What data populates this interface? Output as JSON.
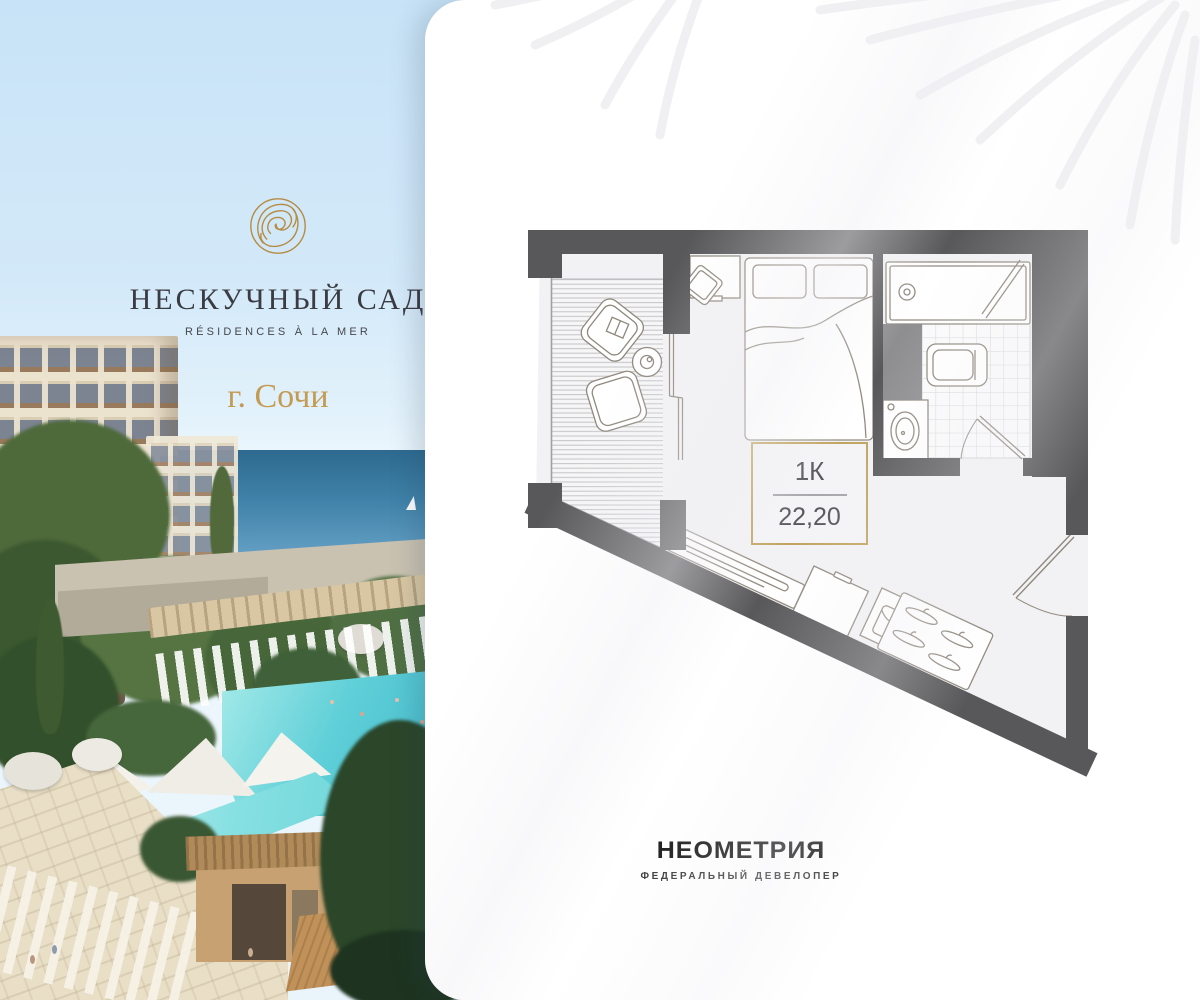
{
  "brand": {
    "title": "НЕСКУЧНЫЙ САД",
    "tagline": "RÉSIDENCES À LA MER",
    "city": "г. Сочи",
    "logo_icon": "gold-spiral-monogram-icon",
    "logo_color": "#b68c44"
  },
  "floor_plan": {
    "unit_type": "1К",
    "area": "22,20",
    "accent_border_color": "#c2a35f",
    "wall_color": "#58585a",
    "floor_color": "#f2f2f4"
  },
  "developer": {
    "name": "НЕОМЕТРИЯ",
    "descriptor": "ФЕДЕРАЛЬНЫЙ ДЕВЕЛОПЕР"
  }
}
